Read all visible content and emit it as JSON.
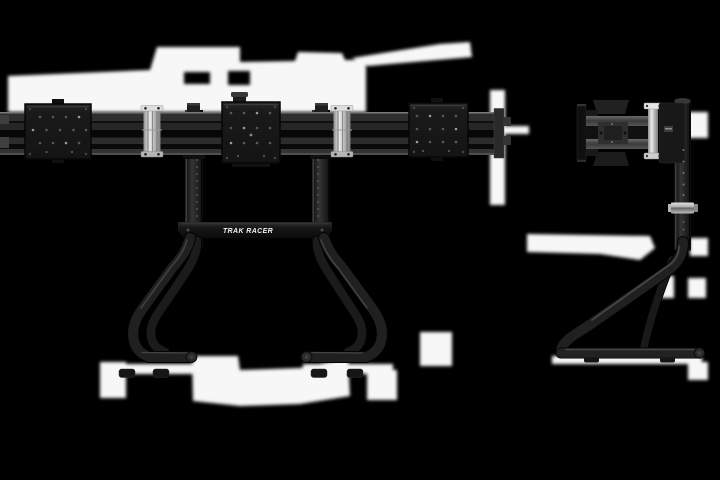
{
  "scene": {
    "background_color": "#000000",
    "brand_label": "TRAK RACER",
    "product": {
      "front_view_name": "triple-monitor-mount-front-view",
      "side_view_name": "monitor-mount-side-view"
    },
    "colors": {
      "frame_dark": "#1e1e1e",
      "frame_edge_highlight": "#4a4a4a",
      "rail_slot_dark": "#070707",
      "clamp_silver": "#c9c9c9",
      "highlight_blob_white": "#ffffff",
      "brand_text": "#f2f2f2"
    }
  }
}
